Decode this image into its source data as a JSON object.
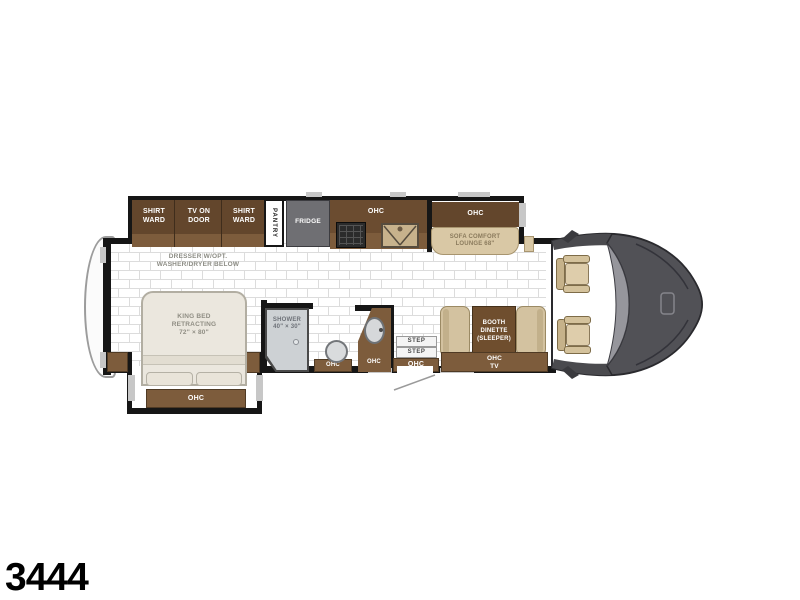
{
  "model_number": "3444",
  "colors": {
    "cabinet_dark": "#63462C",
    "cabinet_light": "#7D5C3C",
    "counter_brown": "#6B4C30",
    "table_brown": "#6F4E2E",
    "tan_upholstery": "#D9C8A5",
    "bed_ivory": "#EBE7DE",
    "fridge_gray": "#6F6F73",
    "shower_gray": "#CDD1D4",
    "cab_gray": "#515156",
    "wall_black": "#161616"
  },
  "galley": {
    "shirt_ward_left": "SHIRT\nWARD",
    "tv_on_door": "TV ON\nDOOR",
    "shirt_ward_right": "SHIRT\nWARD",
    "pantry": "PANTRY",
    "fridge": "FRIDGE",
    "kitchen_ohc": "OHC"
  },
  "living": {
    "sofa_ohc": "OHC",
    "sofa": "SOFA COMFORT\nLOUNGE 68\"",
    "dinette": "BOOTH\nDINETTE\n(SLEEPER)",
    "dinette_ohc": "OHC\nTV"
  },
  "bedroom": {
    "dresser": "DRESSER W/OPT.\nWASHER/DRYER BELOW",
    "king_bed": "KING BED\nRETRACTING\n72\" × 80\"",
    "bed_ohc": "OHC"
  },
  "bath": {
    "shower": "SHOWER\n40\" × 30\"",
    "toilet_ohc": "OHC",
    "vanity_ohc": "OHC"
  },
  "entry": {
    "step_upper": "STEP",
    "step_lower": "STEP",
    "entry_ohc": "OHC"
  }
}
